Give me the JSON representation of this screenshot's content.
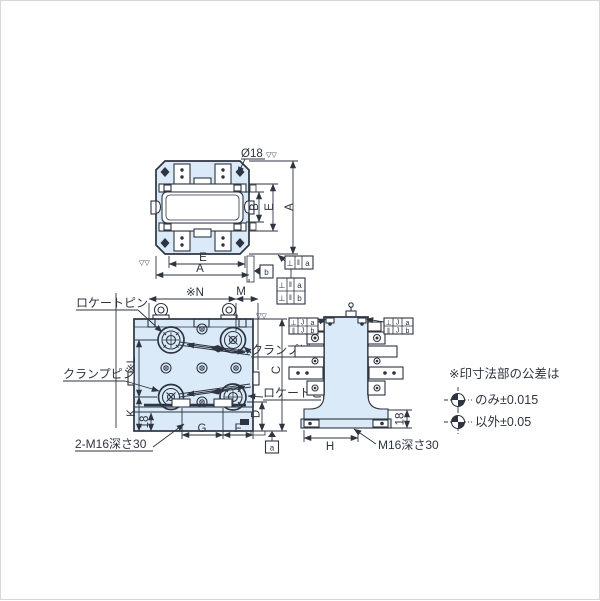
{
  "drawing": {
    "top_view": {
      "dia": "Ø18",
      "dim_b": "B",
      "dim_e_right": "E",
      "dim_a_right": "A",
      "dim_e_bottom": "E",
      "dim_a_bottom": "A"
    },
    "front_view": {
      "locate_pin_left": "ロケートピン",
      "clamp_pin_left": "クランプピン",
      "clamp_pin_right": "クランプピン",
      "locate_pin_right": "ロケートピン",
      "dim_n": "※N",
      "dim_m": "M",
      "dim_l": "※L",
      "dim_k": "K",
      "dim_c": "C",
      "dim_d": "D",
      "dim_18": "18",
      "dim_g": "G",
      "dim_f": "F",
      "tap_note": "2-M16深さ30"
    },
    "side_view": {
      "dim_h": "H",
      "dim_18": "18",
      "tap_note": "M16深さ30"
    },
    "datum_a": "a",
    "datum_b": "b",
    "frames": {
      "top_single": {
        "sym": "⊥",
        "val": "‖",
        "datum": "a"
      },
      "top_double_r1": {
        "sym": "⊥",
        "val": "‖",
        "datum": "a"
      },
      "top_double_r2": {
        "sym": "⊥",
        "val": "‖",
        "datum": "b"
      },
      "side_r1": {
        "sym": "⊥",
        "val": "J",
        "datum": "a"
      },
      "side_r2": {
        "sym": "∥",
        "val": "J",
        "datum": "b"
      }
    },
    "note": {
      "title": "※印寸法部の公差は",
      "only": "のみ±0.015",
      "other": "以外±0.05"
    },
    "icons": {
      "finish_mark": "▽▽"
    },
    "colors": {
      "line": "#2e3440",
      "fill": "#daeaf8",
      "border": "#d7d7d7",
      "background": "#ffffff"
    }
  }
}
